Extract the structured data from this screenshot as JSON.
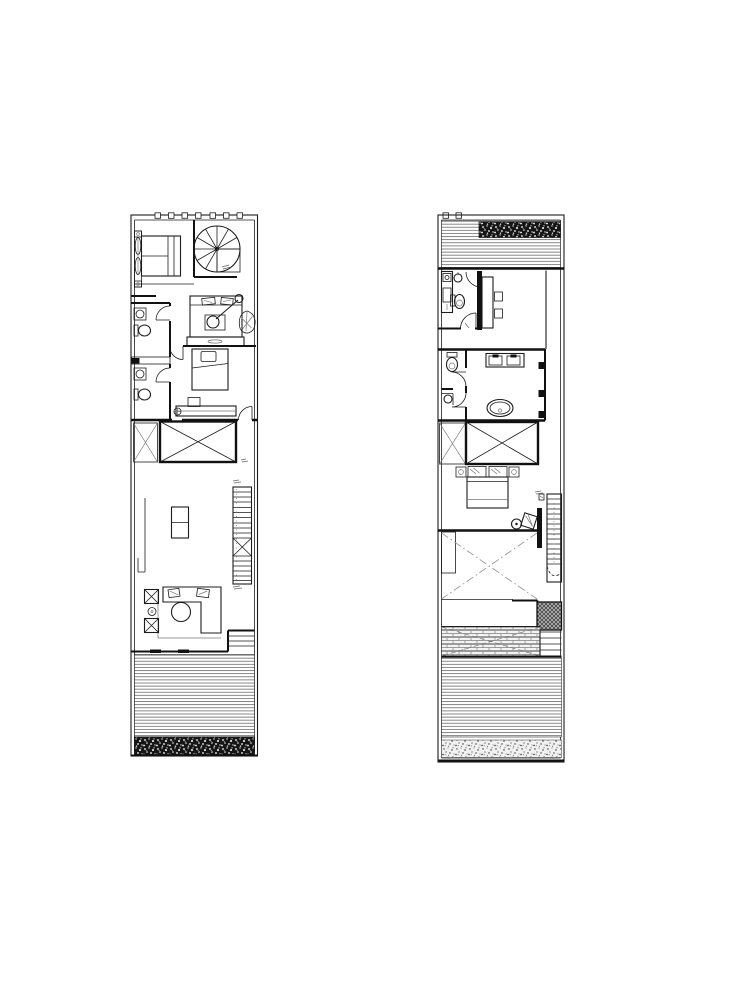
{
  "canvas": {
    "width": 744,
    "height": 998,
    "background": "#ffffff"
  },
  "palette": {
    "paper": "#ffffff",
    "ink": "#1c1c1c",
    "wall": "#111111",
    "deck_line": "#606060",
    "void_line": "#999999",
    "hatch": "#777777"
  },
  "plans": [
    {
      "id": "plan-left",
      "title": "Left floor plan: spiral stair, two bathrooms, bedrooms, kitchen, stair, living room, rear deck",
      "features": [
        "window-wall",
        "wardrobe",
        "double-bed",
        "spiral-staircase",
        "bathroom",
        "sink",
        "toilet",
        "study-bed",
        "reading-lamp",
        "plant",
        "dresser",
        "single-bed",
        "desk",
        "floor-drain",
        "void-opening",
        "kitchen-counter",
        "kitchen-island",
        "straight-staircase",
        "corner-sofa",
        "coffee-table",
        "armchair",
        "side-table",
        "sliding-door",
        "entry-steps",
        "wood-deck",
        "planting-strip"
      ]
    },
    {
      "id": "plan-right",
      "title": "Right floor plan: roof deck, study, master bathroom, master bedroom, stair, patio and deck",
      "features": [
        "wood-deck",
        "planting-strip",
        "shower",
        "sink",
        "toilet",
        "desk",
        "desk-chair",
        "water-closet",
        "double-vanity",
        "bathtub",
        "void-opening",
        "nightstand",
        "double-bed",
        "pillow",
        "lounge-chair",
        "side-table",
        "straight-staircase",
        "planter-hatch",
        "paved-patio",
        "steps"
      ]
    }
  ]
}
